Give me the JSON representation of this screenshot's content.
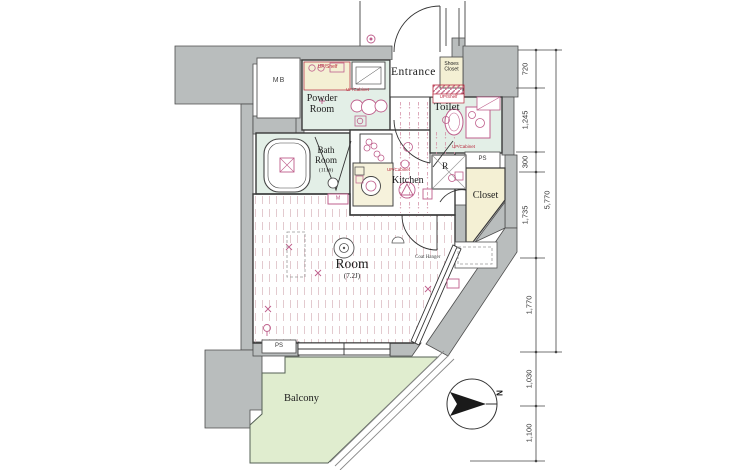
{
  "plan": {
    "rooms": {
      "entrance": "Entrance",
      "shoes_closet_line1": "Shoes",
      "shoes_closet_line2": "Closet",
      "powder_line1": "Powder",
      "powder_line2": "Room",
      "toilet": "Toilet",
      "bath_line1": "Bath",
      "bath_line2": "Room",
      "bath_size": "(1116)",
      "kitchen": "Kitchen",
      "closet": "Closet",
      "main_room": "Room",
      "main_room_size": "(7.2J)",
      "balcony": "Balcony"
    },
    "labels": {
      "mb": "MB",
      "m": "M",
      "r": "R",
      "ps_top": "PS",
      "ps_bottom": "PS",
      "up_shelf_powder": "UP/Shelf",
      "up_cabinet_powder": "UP/Cabinet",
      "up_shelf_toilet": "UP/Shelf",
      "up_cabinet_toilet": "UP/Cabinet",
      "up_cabinet_kitchen": "UP/Cabinet",
      "coat_hanger": "Coat Hanger",
      "north": "N"
    },
    "dimensions": {
      "d720": "720",
      "d1245": "1,245",
      "d300": "300",
      "d1735": "1,735",
      "d1770": "1,770",
      "d1030": "1,030",
      "d1100": "1,100",
      "total": "5,770"
    },
    "colors": {
      "wall": "#b9bdbd",
      "wet_area": "#e3efe7",
      "closet_fill": "#f4f0d4",
      "balcony_fill": "#e0edcf",
      "fixture_pink": "#bf5f8c",
      "label_red": "#b8273b"
    }
  }
}
